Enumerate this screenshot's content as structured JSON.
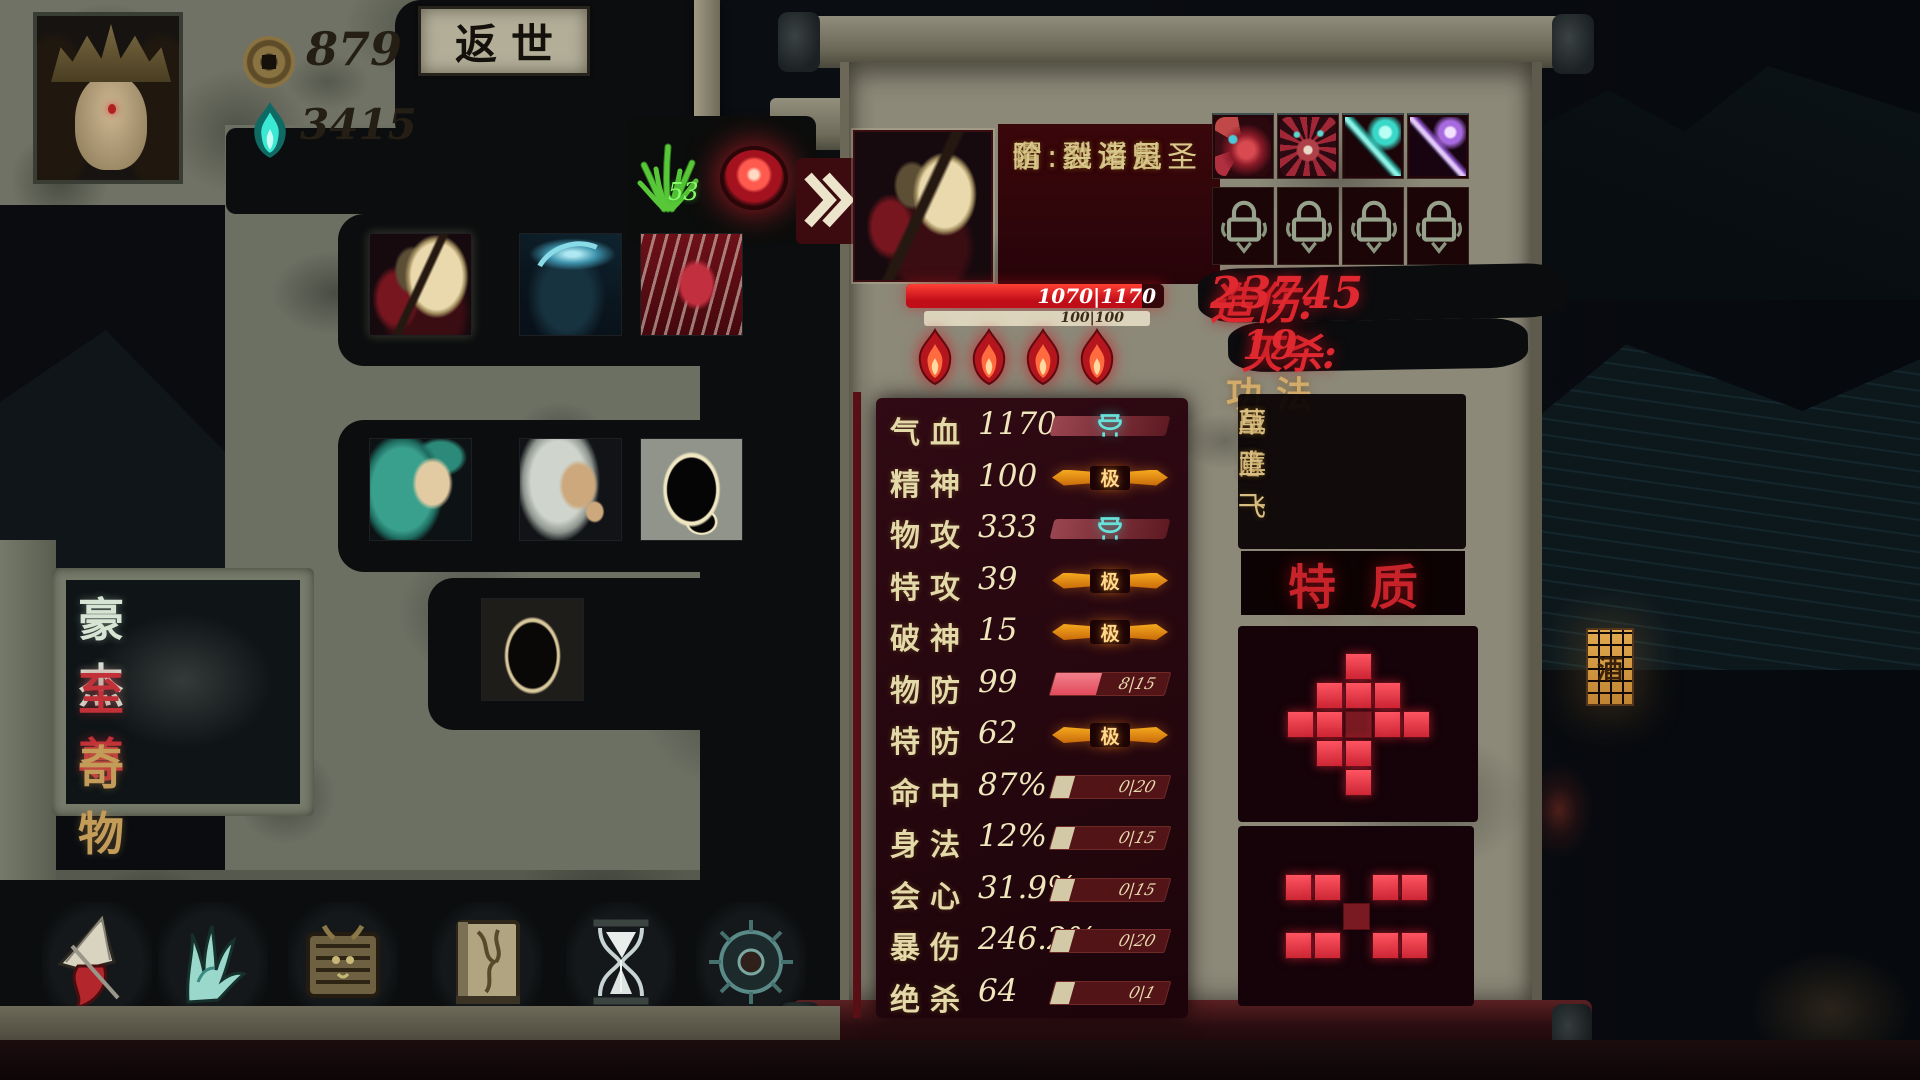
{
  "hud": {
    "coin_count": "879",
    "soul_count": "3415",
    "return_world_button": "返世",
    "herb_count": "53"
  },
  "category_panel": {
    "items": [
      {
        "label": "豪杰"
      },
      {
        "label": "至尊"
      },
      {
        "label": "奇物"
      }
    ]
  },
  "roster": {
    "portraits": [
      {
        "name": "masked-demon",
        "selected": true
      },
      {
        "name": "azure-beast",
        "selected": false
      },
      {
        "name": "crimson-witch",
        "selected": false
      },
      {
        "name": "jade-maiden",
        "selected": false
      },
      {
        "name": "pale-swordswoman",
        "selected": false
      },
      {
        "name": "shadow-silhouette",
        "selected": false
      },
      {
        "name": "dark-recruit",
        "selected": false
      }
    ]
  },
  "character": {
    "name_line": "名:血浮屠",
    "title_line": "谓:戮海魁圣",
    "rank_line": "阶:裂诸灵",
    "hp_text": "1070|1170",
    "spirit_text": "100|100",
    "flames": 4
  },
  "stats": {
    "max_label": "极",
    "rows": [
      {
        "label": "气血",
        "value": "1170",
        "bar": "emblem"
      },
      {
        "label": "精神",
        "value": "100",
        "bar": "max"
      },
      {
        "label": "物攻",
        "value": "333",
        "bar": "emblem"
      },
      {
        "label": "特攻",
        "value": "39",
        "bar": "max"
      },
      {
        "label": "破神",
        "value": "15",
        "bar": "max"
      },
      {
        "label": "物防",
        "value": "99",
        "bar": "progress",
        "bar_text": "8|15",
        "fill": 0.4
      },
      {
        "label": "特防",
        "value": "62",
        "bar": "max"
      },
      {
        "label": "命中",
        "value": "87%",
        "bar": "progress",
        "bar_text": "0|20",
        "fill": 0
      },
      {
        "label": "身法",
        "value": "12%",
        "bar": "progress",
        "bar_text": "0|15",
        "fill": 0
      },
      {
        "label": "会心",
        "value": "31.9%",
        "bar": "progress",
        "bar_text": "0|15",
        "fill": 0
      },
      {
        "label": "暴伤",
        "value": "246.2%",
        "bar": "progress",
        "bar_text": "0|20",
        "fill": 0
      },
      {
        "label": "绝杀",
        "value": "64",
        "bar": "progress",
        "bar_text": "0|1",
        "fill": 0
      }
    ]
  },
  "combat_summary": {
    "damage_label": "造伤:",
    "damage_value": "23745",
    "kill_label": "灭杀:",
    "kill_value": "19"
  },
  "skills": {
    "header": "功法",
    "list": [
      "压阵",
      "战意一",
      "草上飞"
    ]
  },
  "traits": {
    "header": "特质",
    "grids": [
      {
        "rows": [
          "..X..",
          ".XXX.",
          "XXDXX",
          ".XX..",
          "..X.."
        ]
      },
      {
        "rows": [
          "XX.XX",
          "..D..",
          "XX.XX"
        ]
      }
    ]
  },
  "equipment": {
    "items": [
      {
        "name": "crimson-dragon"
      },
      {
        "name": "demon-visage"
      },
      {
        "name": "jade-spear"
      },
      {
        "name": "violet-spear"
      }
    ],
    "locked_slots": 4
  },
  "bottom_menu": {
    "icons": [
      {
        "name": "umbrella"
      },
      {
        "name": "claw-hand"
      },
      {
        "name": "relic-chest"
      },
      {
        "name": "vine-tome"
      },
      {
        "name": "hourglass"
      },
      {
        "name": "mystic-wheel"
      }
    ]
  },
  "ambience": {
    "tavern_sign": "酒"
  },
  "colors": {
    "accent_red": "#cf2128",
    "gold": "#d2b878",
    "teal": "#5fd8d0",
    "hp_red": "#dd1622",
    "parchment": "#8c8979"
  }
}
